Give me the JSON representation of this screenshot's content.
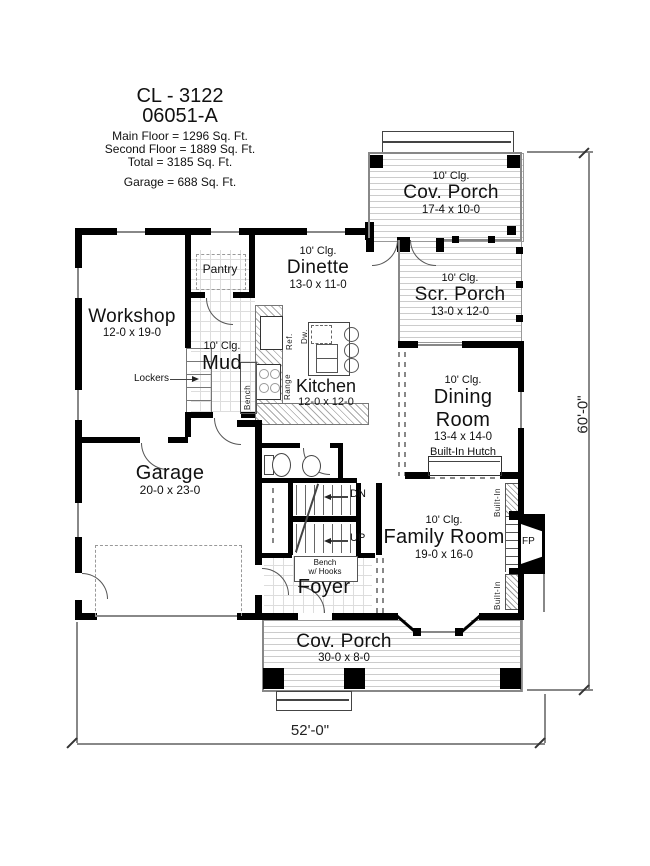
{
  "title_block": {
    "plan_code": "CL - 3122",
    "plan_variant": "06051-A",
    "main_floor": "Main Floor = 1296 Sq. Ft.",
    "second_floor": "Second Floor = 1889 Sq. Ft.",
    "total": "Total = 3185 Sq. Ft.",
    "garage_area": "Garage = 688 Sq. Ft."
  },
  "rooms": {
    "cov_porch_top": {
      "ceiling": "10' Clg.",
      "name": "Cov. Porch",
      "size": "17-4 x 10-0"
    },
    "scr_porch": {
      "ceiling": "10' Clg.",
      "name": "Scr. Porch",
      "size": "13-0 x 12-0"
    },
    "dinette": {
      "ceiling": "10' Clg.",
      "name": "Dinette",
      "size": "13-0 x 11-0"
    },
    "pantry": {
      "name": "Pantry"
    },
    "workshop": {
      "name": "Workshop",
      "size": "12-0 x 19-0"
    },
    "mud": {
      "ceiling": "10' Clg.",
      "name": "Mud"
    },
    "kitchen": {
      "name": "Kitchen",
      "size": "12-0 x 12-0"
    },
    "dining_room": {
      "ceiling": "10' Clg.",
      "name_line1": "Dining",
      "name_line2": "Room",
      "size": "13-4 x 14-0"
    },
    "garage": {
      "name": "Garage",
      "size": "20-0 x 23-0"
    },
    "family_room": {
      "ceiling": "10' Clg.",
      "name": "Family Room",
      "size": "19-0 x 16-0"
    },
    "foyer": {
      "name": "Foyer"
    },
    "cov_porch_bottom": {
      "name": "Cov. Porch",
      "size": "30-0 x 8-0"
    }
  },
  "fixtures": {
    "lockers": "Lockers",
    "mud_bench": "Bench",
    "stair_bench_line1": "Bench",
    "stair_bench_line2": "w/ Hooks",
    "down": "DN",
    "up": "UP",
    "refrigerator": "Ref.",
    "dishwasher": "Dw.",
    "range": "Range",
    "built_in_hutch": "Built-In Hutch",
    "built_in_upper": "Built-In",
    "built_in_lower": "Built-In",
    "fireplace": "FP"
  },
  "dimensions": {
    "height": "60'-0\"",
    "width": "52'-0\""
  }
}
